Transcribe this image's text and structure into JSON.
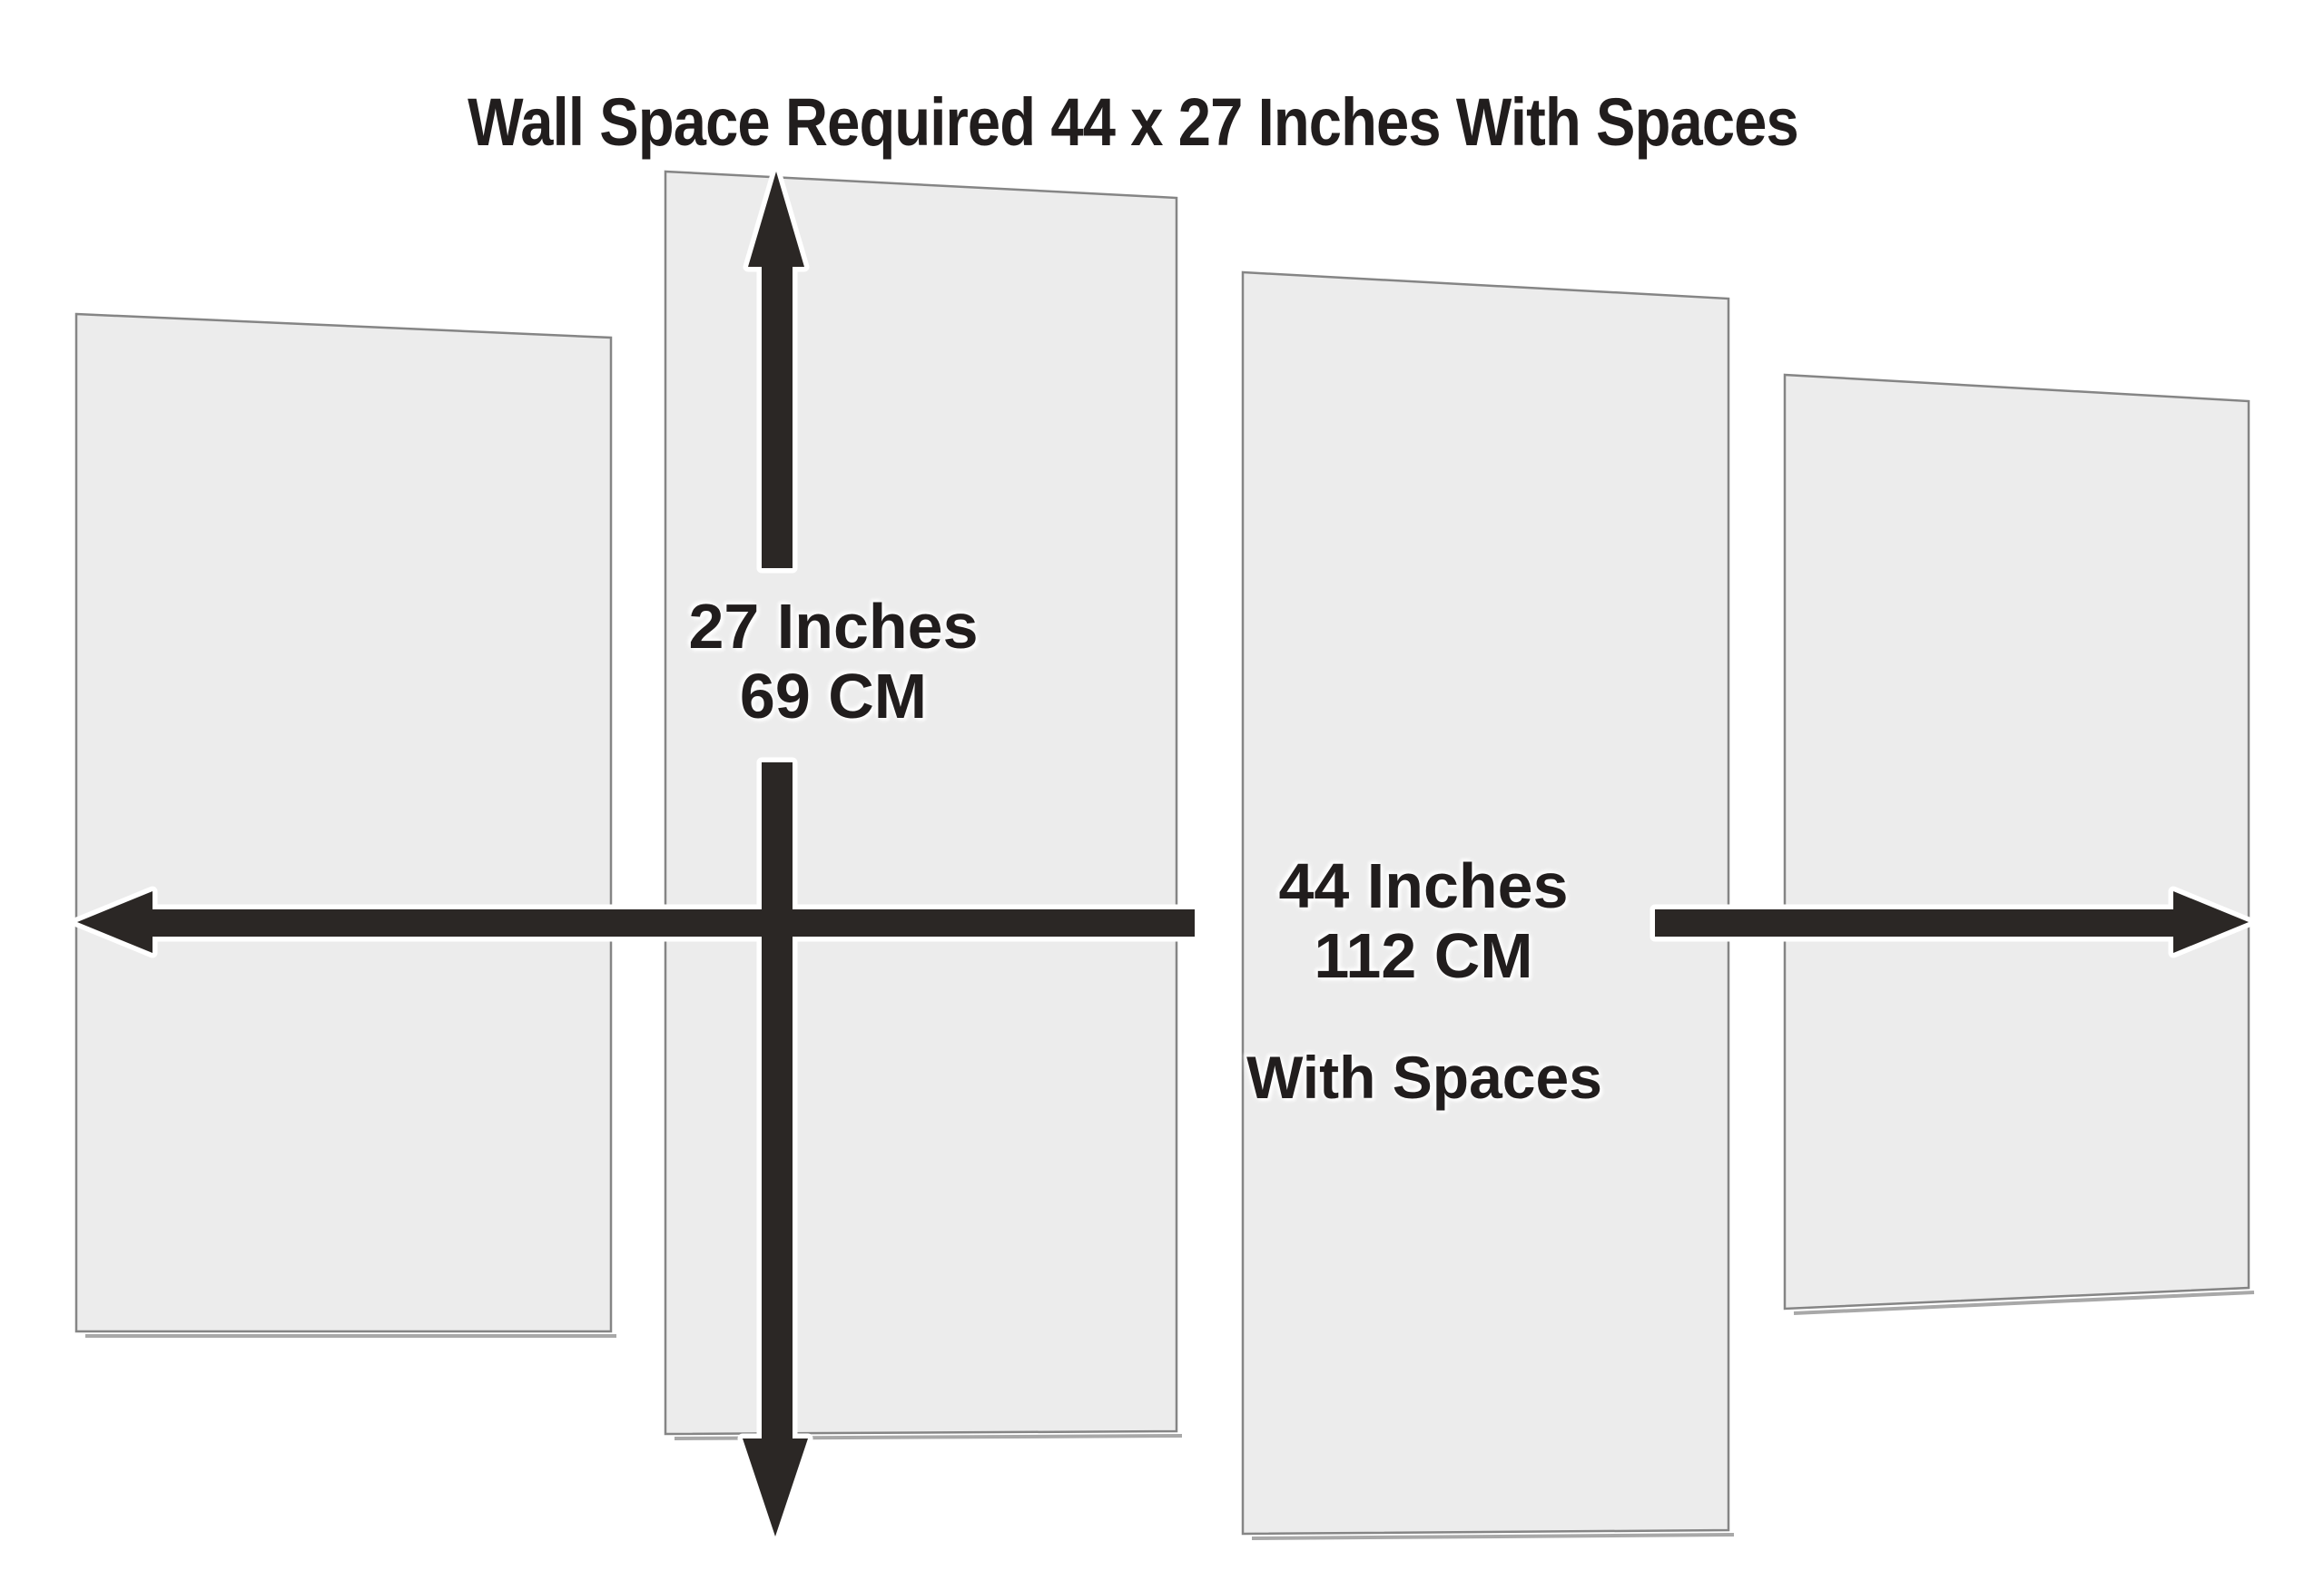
{
  "page": {
    "title": "Wall Space Required 44 x 27 Inches With Spaces"
  },
  "dimensions": {
    "width_label": "44 Inches",
    "width_metric": "112 CM",
    "height_label": "27 Inches",
    "height_metric": "69 CM",
    "note": "With Spaces",
    "panel_count": 4
  },
  "colors": {
    "page_bg": "#ffffff",
    "panel_fill": "#ececec",
    "panel_border": "#858585",
    "panel_shadow": "#a8a8a8",
    "arrow_color": "#2b2725",
    "text_color": "#211d1d"
  }
}
